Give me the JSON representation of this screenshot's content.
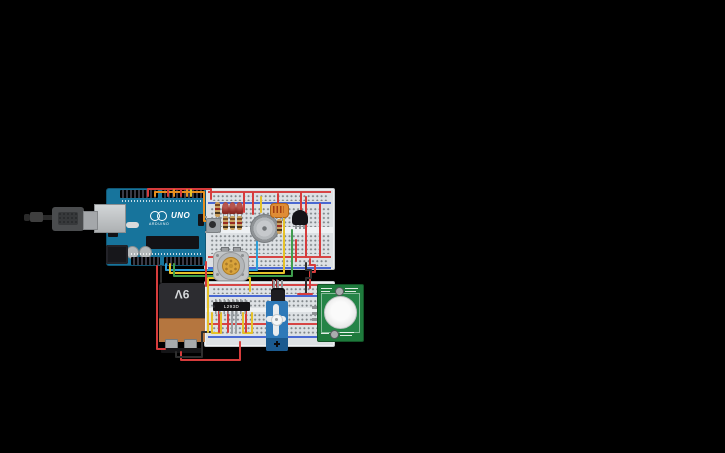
{
  "texts": {
    "uno": "UNO",
    "arduino_brand": "ARDUINO",
    "battery": "9V",
    "motor_driver": "L293D"
  },
  "colors": {
    "board_teal": "#17749c",
    "breadboard": "#dde1e4",
    "pcb_green": "#1e7a3c",
    "wire_red": "#d63c3c",
    "wire_orange": "#e8901e",
    "wire_yellow": "#e6c229",
    "wire_green": "#3f9e4d",
    "wire_blue": "#2d9fd8",
    "wire_black": "#2e2e2e",
    "wire_gray": "#9aa0a4",
    "wire_darkred": "#8e3030"
  },
  "wires": [
    {
      "c": "#d63c3c",
      "p": [
        [
          148,
          196
        ],
        [
          148,
          189
        ],
        [
          211,
          189
        ],
        [
          211,
          199
        ]
      ]
    },
    {
      "c": "#e8901e",
      "p": [
        [
          155,
          196
        ],
        [
          155,
          192
        ],
        [
          204,
          192
        ],
        [
          204,
          221
        ],
        [
          208,
          221
        ]
      ]
    },
    {
      "c": "#d63c3c",
      "p": [
        [
          168,
          190
        ],
        [
          168,
          196
        ]
      ]
    },
    {
      "c": "#e8901e",
      "p": [
        [
          174,
          190
        ],
        [
          174,
          196
        ]
      ]
    },
    {
      "c": "#d63c3c",
      "p": [
        [
          181,
          190
        ],
        [
          181,
          196
        ]
      ]
    },
    {
      "c": "#e8901e",
      "p": [
        [
          187,
          190
        ],
        [
          187,
          196
        ]
      ]
    },
    {
      "c": "#e6c229",
      "p": [
        [
          191,
          190
        ],
        [
          191,
          196
        ]
      ]
    },
    {
      "c": "#d63c3c",
      "p": [
        [
          244,
          193
        ],
        [
          244,
          212
        ]
      ]
    },
    {
      "c": "#d63c3c",
      "p": [
        [
          253,
          193
        ],
        [
          253,
          214
        ]
      ]
    },
    {
      "c": "#e6c229",
      "p": [
        [
          261,
          197
        ],
        [
          261,
          212
        ]
      ]
    },
    {
      "c": "#d63c3c",
      "p": [
        [
          278,
          194
        ],
        [
          278,
          206
        ]
      ]
    },
    {
      "c": "#d63c3c",
      "p": [
        [
          301,
          193
        ],
        [
          301,
          213
        ]
      ]
    },
    {
      "c": "#d63c3c",
      "p": [
        [
          306,
          197
        ],
        [
          306,
          257
        ]
      ]
    },
    {
      "c": "#d63c3c",
      "p": [
        [
          320,
          204
        ],
        [
          320,
          256
        ]
      ]
    },
    {
      "c": "#2d9fd8",
      "p": [
        [
          166,
          264
        ],
        [
          166,
          270
        ],
        [
          257,
          270
        ],
        [
          257,
          241
        ]
      ]
    },
    {
      "c": "#e6c229",
      "p": [
        [
          170,
          264
        ],
        [
          170,
          273
        ],
        [
          284,
          273
        ],
        [
          284,
          219
        ]
      ]
    },
    {
      "c": "#3f9e4d",
      "p": [
        [
          174,
          264
        ],
        [
          174,
          276
        ],
        [
          292,
          276
        ],
        [
          292,
          230
        ]
      ]
    },
    {
      "c": "#d63c3c",
      "p": [
        [
          296,
          240
        ],
        [
          296,
          261
        ]
      ]
    },
    {
      "c": "#2e2e2e",
      "p": [
        [
          161,
          266
        ],
        [
          161,
          282
        ]
      ]
    },
    {
      "c": "#d63c3c",
      "p": [
        [
          157,
          266
        ],
        [
          157,
          349
        ],
        [
          165,
          349
        ]
      ]
    },
    {
      "c": "#d63c3c",
      "p": [
        [
          181,
          352
        ],
        [
          181,
          360
        ],
        [
          240,
          360
        ],
        [
          240,
          342
        ]
      ]
    },
    {
      "c": "#2e2e2e",
      "p": [
        [
          176,
          352
        ],
        [
          176,
          357
        ],
        [
          202,
          357
        ],
        [
          202,
          332
        ],
        [
          210,
          332
        ]
      ]
    },
    {
      "c": "#d63c3c",
      "p": [
        [
          206,
          262
        ],
        [
          206,
          286
        ]
      ]
    },
    {
      "c": "#d63c3c",
      "p": [
        [
          310,
          259
        ],
        [
          310,
          265
        ],
        [
          315,
          265
        ],
        [
          315,
          272
        ],
        [
          310,
          272
        ],
        [
          310,
          288
        ]
      ]
    },
    {
      "c": "#2e2e2e",
      "p": [
        [
          306,
          263
        ],
        [
          306,
          270
        ],
        [
          311,
          270
        ],
        [
          311,
          278
        ],
        [
          306,
          278
        ],
        [
          306,
          293
        ]
      ]
    },
    {
      "c": "#e6c229",
      "p": [
        [
          208,
          332
        ],
        [
          208,
          278
        ],
        [
          250,
          278
        ],
        [
          250,
          291
        ]
      ]
    },
    {
      "c": "#e6c229",
      "p": [
        [
          212,
          313
        ],
        [
          212,
          333
        ],
        [
          221,
          333
        ],
        [
          221,
          313
        ]
      ]
    },
    {
      "c": "#e6c229",
      "p": [
        [
          243,
          313
        ],
        [
          243,
          333
        ],
        [
          252,
          333
        ],
        [
          252,
          313
        ]
      ]
    },
    {
      "c": "#d63c3c",
      "p": [
        [
          219,
          311
        ],
        [
          219,
          332
        ]
      ]
    },
    {
      "c": "#d63c3c",
      "p": [
        [
          228,
          311
        ],
        [
          228,
          332
        ]
      ]
    },
    {
      "c": "#d63c3c",
      "p": [
        [
          246,
          311
        ],
        [
          246,
          332
        ]
      ]
    },
    {
      "c": "#9aa0a4",
      "p": [
        [
          232,
          305
        ],
        [
          232,
          333
        ]
      ]
    },
    {
      "c": "#9aa0a4",
      "p": [
        [
          236,
          305
        ],
        [
          236,
          333
        ]
      ]
    },
    {
      "c": "#8e3030",
      "p": [
        [
          273,
          280
        ],
        [
          273,
          287
        ]
      ]
    },
    {
      "c": "#8e3030",
      "p": [
        [
          277,
          280
        ],
        [
          277,
          287
        ]
      ]
    },
    {
      "c": "#d63c3c",
      "p": [
        [
          298,
          294
        ],
        [
          312,
          294
        ]
      ]
    }
  ]
}
